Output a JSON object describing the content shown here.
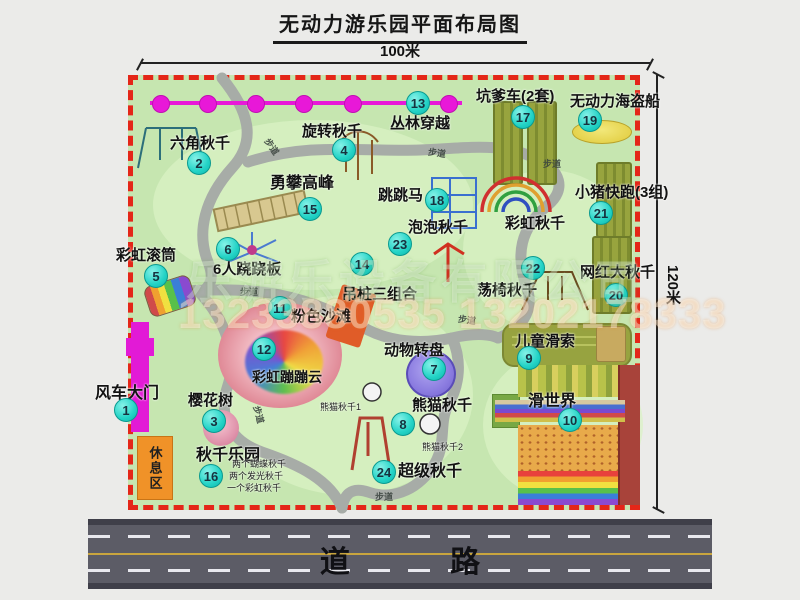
{
  "title": "无动力游乐园平面布局图",
  "dimensions": {
    "width_label": "100米",
    "height_label": "120米"
  },
  "road": {
    "label": "道 路"
  },
  "watermark": {
    "company": "乐游乐设备有限公司",
    "phone": "13233880535 13202178333"
  },
  "colors": {
    "map_green": "#c6e6b0",
    "border_red": "#e42618",
    "badge_cyan": "#23d3c6",
    "gate_magenta": "#e21ad6",
    "path_gray": "#a7aca7",
    "road_gray": "#5c5c66",
    "rest_orange": "#f09228",
    "mat_olive": "#98a43e"
  },
  "map": {
    "rest_area_label": "休息区",
    "attractions": [
      {
        "num": "1",
        "label": "风车大门",
        "lx": 95,
        "ly": 386,
        "bx": 126,
        "by": 410,
        "size": 16
      },
      {
        "num": "2",
        "label": "六角秋千",
        "lx": 170,
        "ly": 136,
        "bx": 199,
        "by": 163,
        "size": 15
      },
      {
        "num": "3",
        "label": "樱花树",
        "lx": 188,
        "ly": 393,
        "bx": 214,
        "by": 421,
        "size": 15
      },
      {
        "num": "4",
        "label": "旋转秋千",
        "lx": 302,
        "ly": 124,
        "bx": 344,
        "by": 150,
        "size": 15
      },
      {
        "num": "5",
        "label": "彩虹滚筒",
        "lx": 116,
        "ly": 248,
        "bx": 156,
        "by": 276,
        "size": 15
      },
      {
        "num": "6",
        "label": "6人跷跷板",
        "lx": 213,
        "ly": 262,
        "bx": 228,
        "by": 249,
        "size": 15
      },
      {
        "num": "7",
        "label": "动物转盘",
        "lx": 384,
        "ly": 343,
        "bx": 434,
        "by": 369,
        "size": 15
      },
      {
        "num": "8",
        "label": "熊猫秋千",
        "lx": 412,
        "ly": 398,
        "bx": 403,
        "by": 424,
        "size": 15
      },
      {
        "label": "熊猫秋千1",
        "lx": 320,
        "ly": 403,
        "size": 9,
        "small": true
      },
      {
        "label": "熊猫秋千2",
        "lx": 422,
        "ly": 443,
        "size": 9,
        "small": true
      },
      {
        "num": "9",
        "label": "儿童滑索",
        "lx": 515,
        "ly": 334,
        "bx": 529,
        "by": 358,
        "size": 15
      },
      {
        "num": "10",
        "label": "滑世界",
        "lx": 528,
        "ly": 394,
        "bx": 570,
        "by": 420,
        "size": 16
      },
      {
        "num": "11",
        "label": "粉色沙滩",
        "lx": 291,
        "ly": 309,
        "bx": 280,
        "by": 308,
        "size": 15
      },
      {
        "num": "12",
        "label": "彩虹蹦蹦云",
        "lx": 252,
        "ly": 370,
        "bx": 264,
        "by": 349,
        "size": 14
      },
      {
        "num": "13",
        "label": "丛林穿越",
        "lx": 390,
        "ly": 116,
        "bx": 418,
        "by": 103,
        "size": 15
      },
      {
        "num": "14",
        "label": "吊桩三组合",
        "lx": 342,
        "ly": 287,
        "bx": 362,
        "by": 264,
        "size": 15
      },
      {
        "num": "15",
        "label": "勇攀高峰",
        "lx": 270,
        "ly": 176,
        "bx": 310,
        "by": 209,
        "size": 16
      },
      {
        "num": "16",
        "label": "秋千乐园",
        "lx": 196,
        "ly": 448,
        "bx": 211,
        "by": 476,
        "size": 16
      },
      {
        "label": "两个蝴蝶秋千",
        "lx": 232,
        "ly": 460,
        "size": 9,
        "small": true
      },
      {
        "label": "两个发光秋千",
        "lx": 229,
        "ly": 472,
        "size": 9,
        "small": true
      },
      {
        "label": "一个彩虹秋千",
        "lx": 227,
        "ly": 484,
        "size": 9,
        "small": true
      },
      {
        "num": "17",
        "label": "坑爹车(2套)",
        "lx": 476,
        "ly": 89,
        "bx": 523,
        "by": 117,
        "size": 15
      },
      {
        "num": "18",
        "label": "跳跳马",
        "lx": 378,
        "ly": 188,
        "bx": 437,
        "by": 200,
        "size": 15
      },
      {
        "num": "19",
        "label": "无动力海盗船",
        "lx": 570,
        "ly": 94,
        "bx": 590,
        "by": 120,
        "size": 15
      },
      {
        "num": "20",
        "label": "网红大秋千",
        "lx": 580,
        "ly": 265,
        "bx": 616,
        "by": 295,
        "size": 15
      },
      {
        "num": "21",
        "label": "小猪快跑(3组)",
        "lx": 575,
        "ly": 185,
        "bx": 601,
        "by": 213,
        "size": 15
      },
      {
        "num": "22",
        "label": "荡椅秋千",
        "lx": 477,
        "ly": 283,
        "bx": 533,
        "by": 268,
        "size": 15
      },
      {
        "num": "23",
        "label": "泡泡秋千",
        "lx": 408,
        "ly": 220,
        "bx": 400,
        "by": 244,
        "size": 15
      },
      {
        "num": "24",
        "label": "超级秋千",
        "lx": 398,
        "ly": 464,
        "bx": 384,
        "by": 472,
        "size": 16
      },
      {
        "label": "彩虹秋千",
        "lx": 505,
        "ly": 216,
        "size": 15
      }
    ],
    "path_labels": [
      {
        "label": "步道",
        "x": 263,
        "y": 140,
        "rot": 55
      },
      {
        "label": "步道",
        "x": 428,
        "y": 146,
        "rot": 8
      },
      {
        "label": "步道",
        "x": 543,
        "y": 157,
        "rot": 0
      },
      {
        "label": "步道",
        "x": 240,
        "y": 285,
        "rot": 0
      },
      {
        "label": "步道",
        "x": 250,
        "y": 408,
        "rot": 75
      },
      {
        "label": "步道",
        "x": 458,
        "y": 313,
        "rot": 8
      },
      {
        "label": "步道",
        "x": 375,
        "y": 490,
        "rot": 0
      }
    ]
  }
}
